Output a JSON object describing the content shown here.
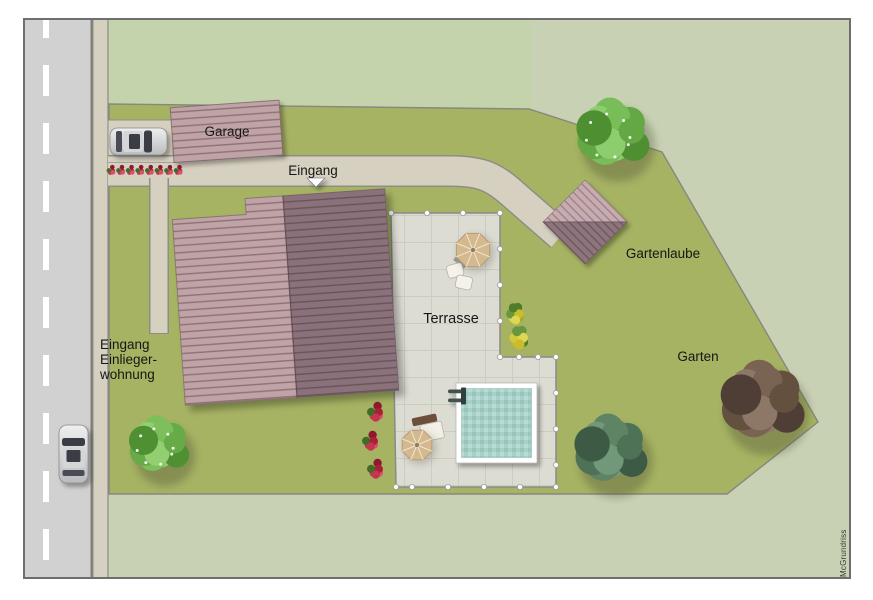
{
  "plan": {
    "labels": {
      "garage": "Garage",
      "eingang": "Eingang",
      "gartenlaube": "Gartenlaube",
      "terrasse": "Terrasse",
      "garten": "Garten",
      "einliegerwohnung_lines": [
        "Eingang",
        "Einlieger-",
        "wohnung"
      ],
      "credit": "McGrundriss"
    },
    "colors": {
      "background_outside": "#c8d1b3",
      "neighbor_lawn": "#c5d3ac",
      "property_lawn": "#a6b363",
      "road": "#d1d1d1",
      "road_marking": "#ffffff",
      "path": "#d6d0c0",
      "terrace": "#dddcd3",
      "pool_water": "#a7d0c8",
      "roof_light": "#c0a3a6",
      "roof_dark": "#8b717a",
      "frame_border": "#6e6e6e"
    }
  }
}
